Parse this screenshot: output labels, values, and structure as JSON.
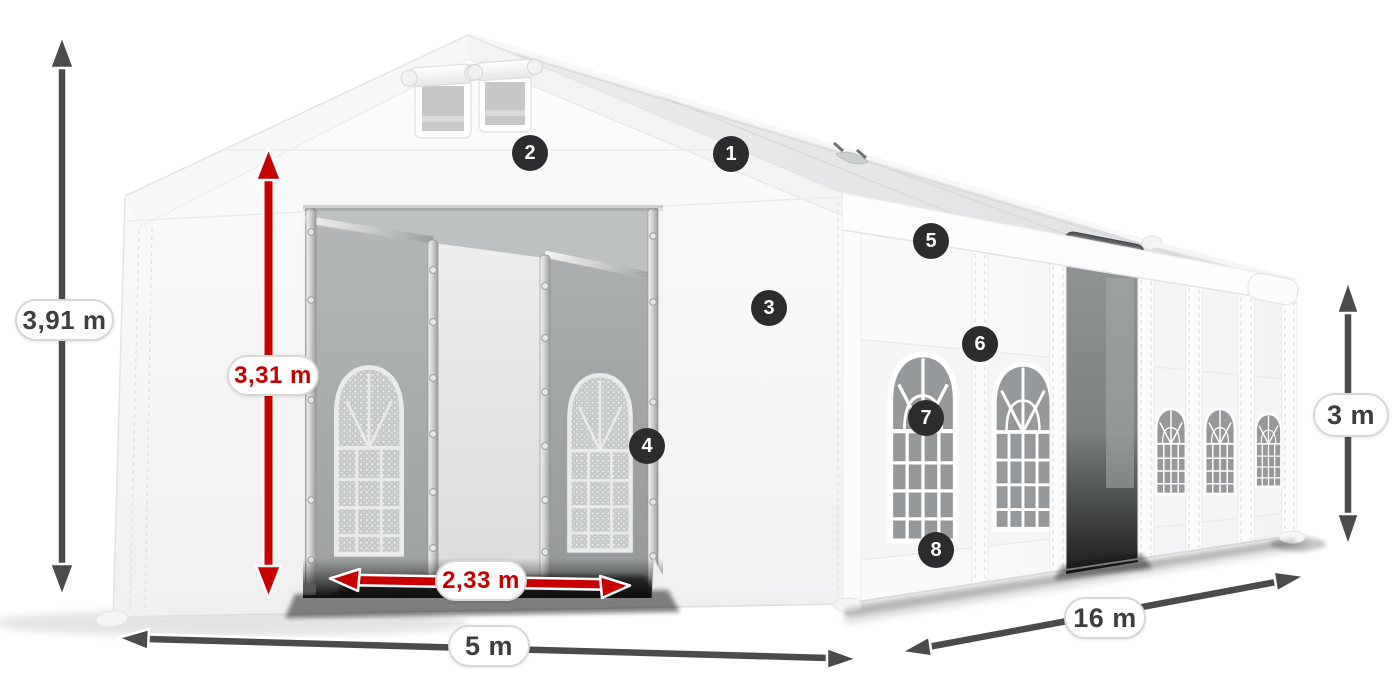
{
  "diagram": {
    "subject": "party-tent-dimension-diagram"
  },
  "colors": {
    "background": "#ffffff",
    "dimension_red": "#c80000",
    "dimension_gray": "#4b4b4b",
    "marker_background": "#2c2c2e",
    "marker_text": "#ffffff",
    "pill_background": "#ffffff",
    "pill_border": "#d7d7d8",
    "pill_text": "#3e3e3e"
  },
  "dimensions": {
    "total_height": {
      "label": "3,91 m",
      "style": "gray",
      "orientation": "vertical"
    },
    "inner_height": {
      "label": "3,31 m",
      "style": "red",
      "orientation": "vertical"
    },
    "entrance_width": {
      "label": "2,33 m",
      "style": "red",
      "orientation": "horizontal"
    },
    "front_width": {
      "label": "5 m",
      "style": "gray",
      "orientation": "horizontal"
    },
    "side_length": {
      "label": "16 m",
      "style": "gray",
      "orientation": "diagonal"
    },
    "side_height": {
      "label": "3 m",
      "style": "gray",
      "orientation": "vertical"
    }
  },
  "markers": [
    {
      "number": "1"
    },
    {
      "number": "2"
    },
    {
      "number": "3"
    },
    {
      "number": "4"
    },
    {
      "number": "5"
    },
    {
      "number": "6"
    },
    {
      "number": "7"
    },
    {
      "number": "8"
    }
  ]
}
